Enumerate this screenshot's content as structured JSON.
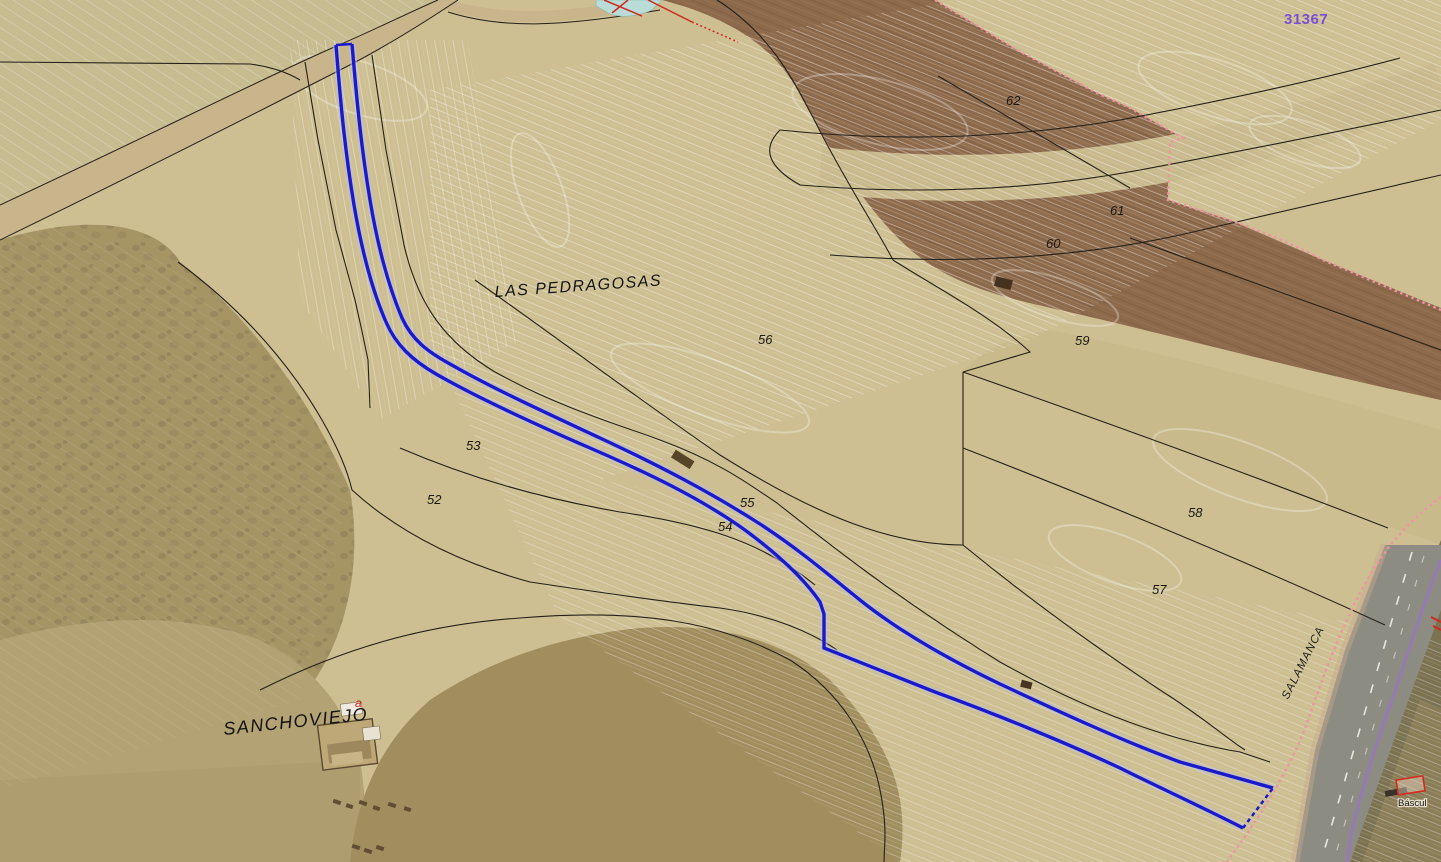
{
  "map": {
    "region_name": "LAS PEDRAGOSAS",
    "settlement_name": "SANCHOVIEJO",
    "road_name": "SALAMANCA",
    "sheet_number": "31367",
    "building_label": "Báscul",
    "subparcel_letter": "a",
    "parcels": [
      {
        "number": "52"
      },
      {
        "number": "53"
      },
      {
        "number": "54"
      },
      {
        "number": "55"
      },
      {
        "number": "56"
      },
      {
        "number": "57"
      },
      {
        "number": "58"
      },
      {
        "number": "59"
      },
      {
        "number": "60"
      },
      {
        "number": "61"
      },
      {
        "number": "62"
      }
    ],
    "colors": {
      "parcel_highlight_blue": "#1b1acb",
      "boundary_pink": "#ef93a4",
      "road_overlay_purple": "#9678bc",
      "label_red": "#cc2418",
      "sheet_number_purple": "#7b50d2",
      "parcel_line_black": "#262018"
    }
  }
}
